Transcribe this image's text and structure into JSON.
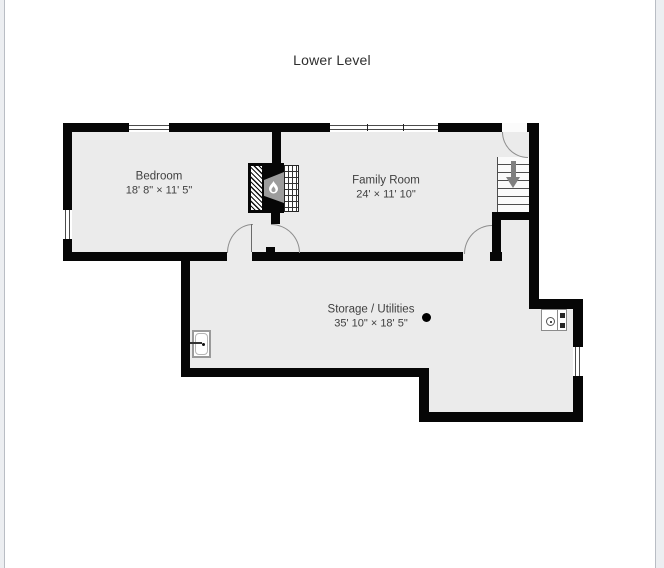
{
  "page": {
    "title": "Lower Level"
  },
  "rooms": {
    "bedroom": {
      "name": "Bedroom",
      "dimensions": "18' 8\" × 11' 5\""
    },
    "family_room": {
      "name": "Family Room",
      "dimensions": "24' × 11' 10\""
    },
    "storage": {
      "name": "Storage / Utilities",
      "dimensions": "35' 10\" × 18' 5\""
    }
  },
  "stairs": {
    "direction": "down"
  },
  "fixtures": {
    "fireplace": "fireplace with flame symbol",
    "sink": "utility sink",
    "appliance": "utility appliance",
    "column": "support column"
  },
  "colors": {
    "wall": "#060606",
    "floor": "#ebebeb",
    "page_background": "#ffffff",
    "page_edge": "#eceef1",
    "stairs_arrow": "#7f7f7f",
    "label_text": "#404040"
  }
}
